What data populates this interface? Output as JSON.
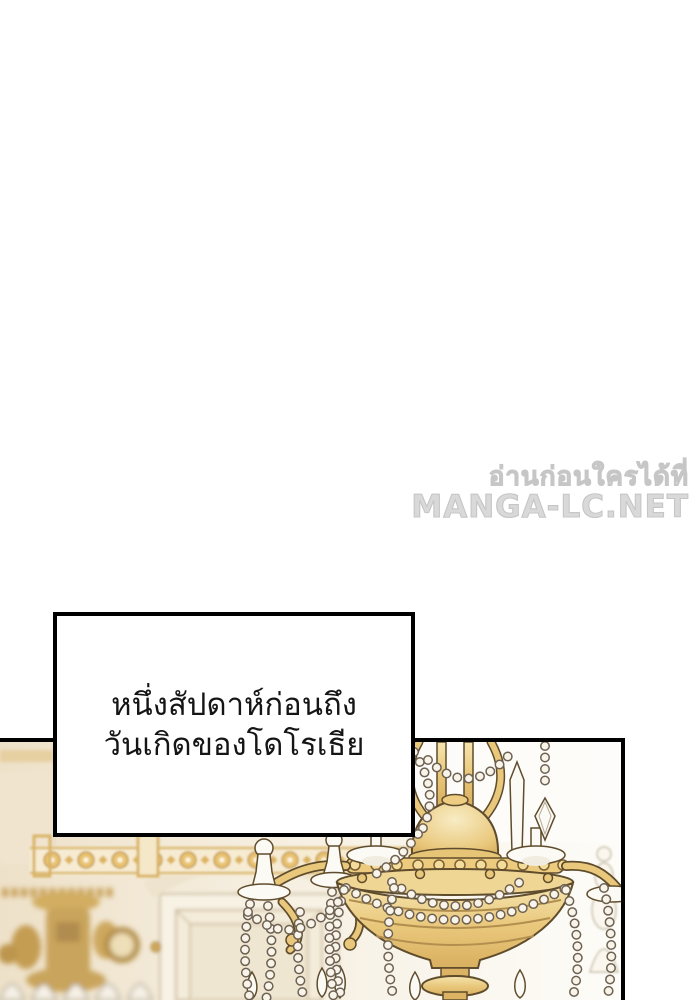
{
  "page": {
    "background_color": "#ffffff"
  },
  "watermark": {
    "line1": "อ่านก่อนใครได้ที่",
    "line2": "MANGA-LC.NET",
    "text_color": "#d9d9d9",
    "outline_color": "#c6c6c6"
  },
  "narration_box": {
    "lines": [
      "หนึ่งสัปดาห์ก่อนถึง",
      "วันเกิดของโดโรเธีย"
    ],
    "background_color": "#ffffff",
    "border_color": "#000000",
    "text_color": "#151515"
  },
  "panel": {
    "border_color": "#000000",
    "palette": {
      "wall_cream": "#eee1c9",
      "wall_light": "#fdfcf8",
      "gold": "#e9c87c",
      "gold_deep": "#d9af60",
      "gold_pale": "#f6e5b0",
      "outline_brown": "#5f4c2c",
      "pearl_white": "#f8f4ea",
      "pearl_outline": "#6e6152"
    },
    "elements": [
      "palace-wall",
      "gold-ornament-frieze",
      "gold-console",
      "door-panel",
      "chandelier",
      "crystal-spire"
    ]
  }
}
